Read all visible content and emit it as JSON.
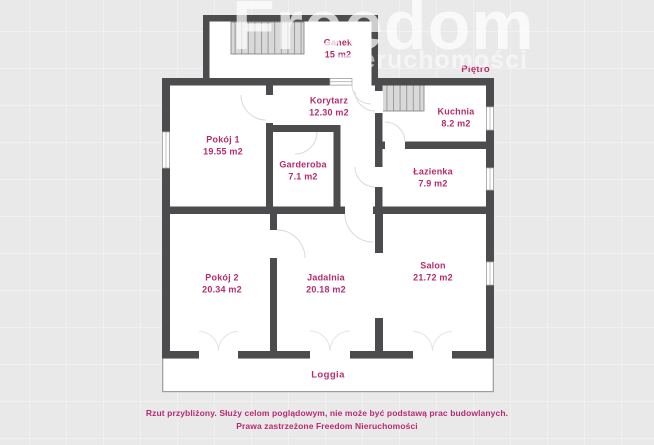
{
  "watermark": {
    "line1": "Freedom",
    "line2": "nieruchomości"
  },
  "floor_label": "Piętro",
  "plan": {
    "rooms": [
      {
        "name": "Ganek",
        "area": "15 m2",
        "cx": 176,
        "cy": 34
      },
      {
        "name": "Korytarz",
        "area": "12.30 m2",
        "cx": 167,
        "cy": 92
      },
      {
        "name": "Kuchnia",
        "area": "8.2 m2",
        "cx": 294,
        "cy": 103
      },
      {
        "name": "Pokój 1",
        "area": "19.55 m2",
        "cx": 61,
        "cy": 131
      },
      {
        "name": "Garderoba",
        "area": "7.1 m2",
        "cx": 141,
        "cy": 156
      },
      {
        "name": "Łazienka",
        "area": "7.9 m2",
        "cx": 271,
        "cy": 163
      },
      {
        "name": "Pokój 2",
        "area": "20.34 m2",
        "cx": 60,
        "cy": 269
      },
      {
        "name": "Jadalnia",
        "area": "20.18 m2",
        "cx": 164,
        "cy": 269
      },
      {
        "name": "Salon",
        "area": "21.72 m2",
        "cx": 271,
        "cy": 257
      }
    ],
    "loggia": {
      "name": "Loggia",
      "cx": 166,
      "cy": 360
    }
  },
  "disclaimer": {
    "line1": "Rzut przybliżony. Służy celom poglądowym, nie może być podstawą prac budowlanych.",
    "line2": "Prawa zastrzeżone Freedom Nieruchomości"
  },
  "colors": {
    "label": "#b72b6e",
    "wall": "#4c4c4e",
    "background": "#e9e9ea"
  }
}
